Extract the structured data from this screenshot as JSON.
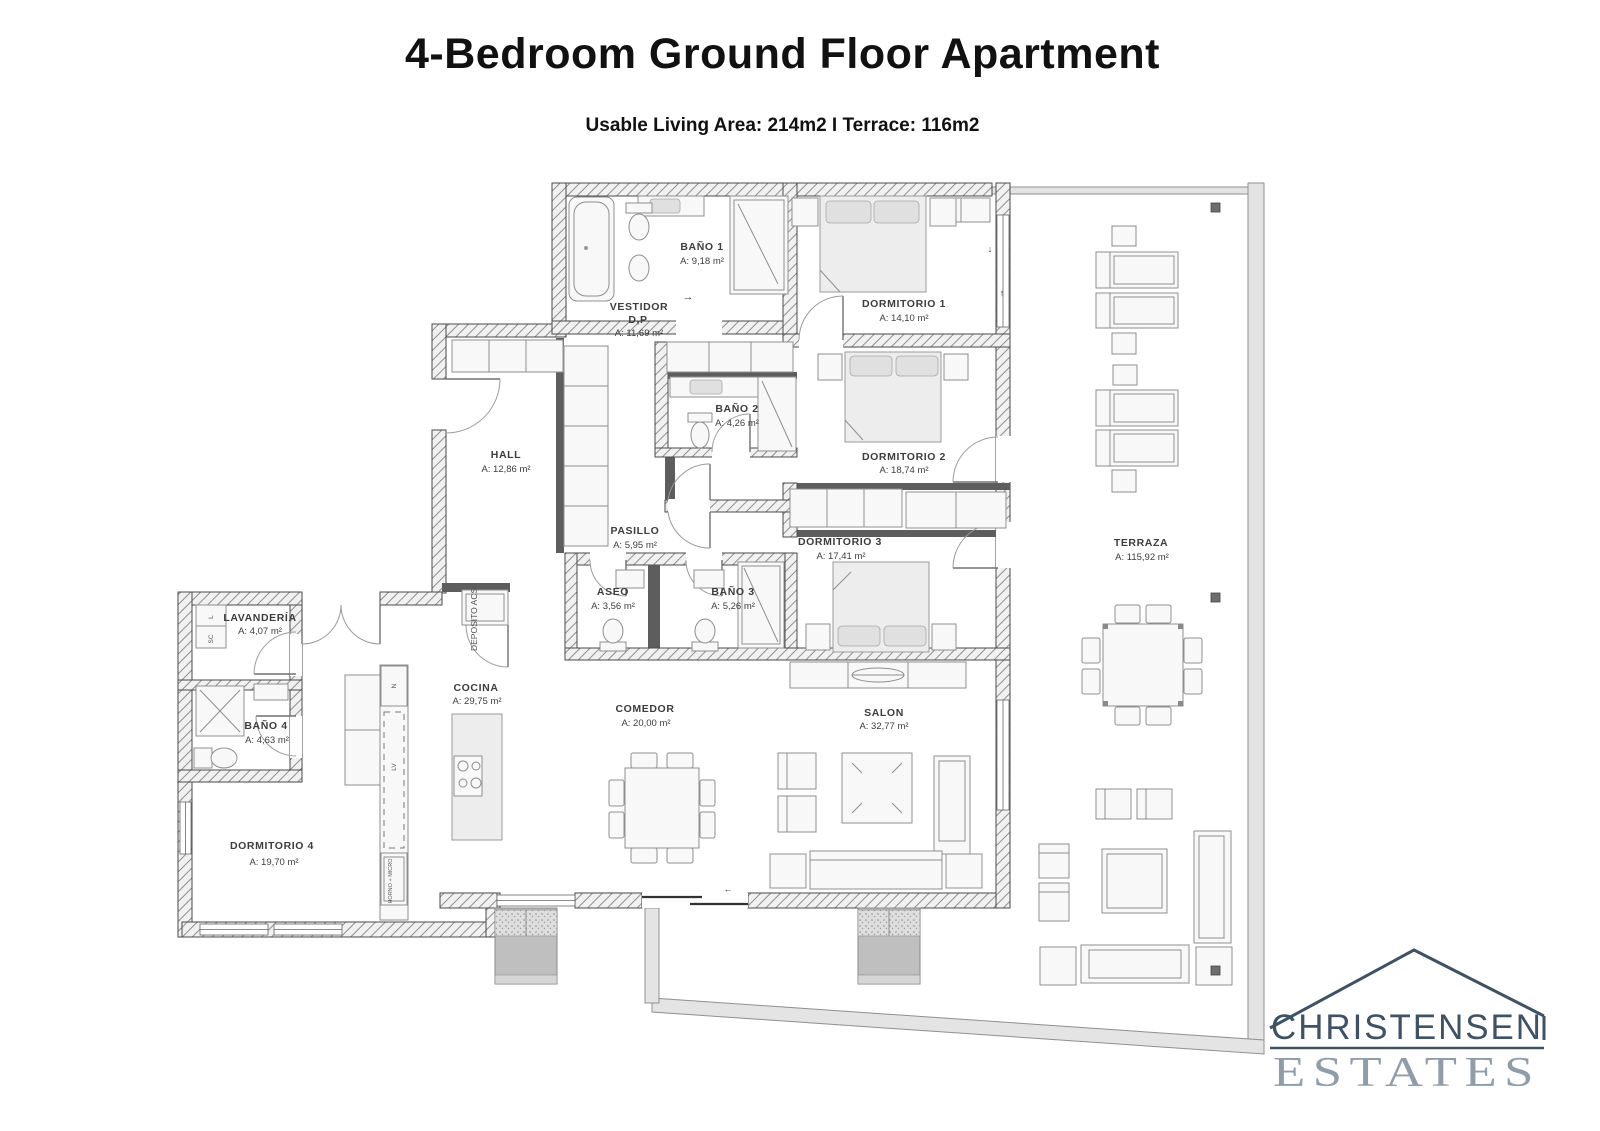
{
  "header": {
    "title": "4-Bedroom Ground Floor Apartment",
    "subtitle": "Usable Living Area: 214m2 I Terrace: 116m2"
  },
  "plan": {
    "rooms": {
      "bano1": {
        "name": "BAÑO 1",
        "area": "A: 9,18 m²"
      },
      "vestidor": {
        "name": "VESTIDOR",
        "sub": "D,P",
        "area": "A: 11,69 m²"
      },
      "dormitorio1": {
        "name": "DORMITORIO 1",
        "area": "A: 14,10 m²"
      },
      "bano2": {
        "name": "BAÑO 2",
        "area": "A: 4,26 m²"
      },
      "dormitorio2": {
        "name": "DORMITORIO 2",
        "area": "A: 18,74 m²"
      },
      "hall": {
        "name": "HALL",
        "area": "A: 12,86 m²"
      },
      "pasillo": {
        "name": "PASILLO",
        "area": "A: 5,95 m²"
      },
      "dormitorio3": {
        "name": "DORMITORIO 3",
        "area": "A: 17,41 m²"
      },
      "terraza": {
        "name": "TERRAZA",
        "area": "A: 115,92 m²"
      },
      "lavanderia": {
        "name": "LAVANDERÍA",
        "area": "A: 4,07 m²"
      },
      "aseo": {
        "name": "ASEO",
        "area": "A: 3,56 m²"
      },
      "bano3": {
        "name": "BAÑO 3",
        "area": "A: 5,26 m²"
      },
      "bano4": {
        "name": "BAÑO 4",
        "area": "A: 4,63 m²"
      },
      "cocina": {
        "name": "COCINA",
        "area": "A: 29,75 m²"
      },
      "comedor": {
        "name": "COMEDOR",
        "area": "A: 20,00 m²"
      },
      "salon": {
        "name": "SALON",
        "area": "A: 32,77 m²"
      },
      "dormitorio4": {
        "name": "DORMITORIO 4",
        "area": "A: 19,70 m²"
      }
    },
    "fixtures": {
      "deposito": "DEPOSITO ACS",
      "horno_micro": "HORNO + MICRO",
      "nevera": "N",
      "lavavajillas": "LV",
      "lavadora": "L",
      "secadora": "SC"
    },
    "arrows": {
      "right": "→",
      "left": "←",
      "down": "↓",
      "up": "↑"
    }
  },
  "logo": {
    "name": "CHRISTENSEN",
    "suffix": "ESTATES",
    "primary_color": "#3d5266",
    "secondary_color": "#8f9dab"
  }
}
